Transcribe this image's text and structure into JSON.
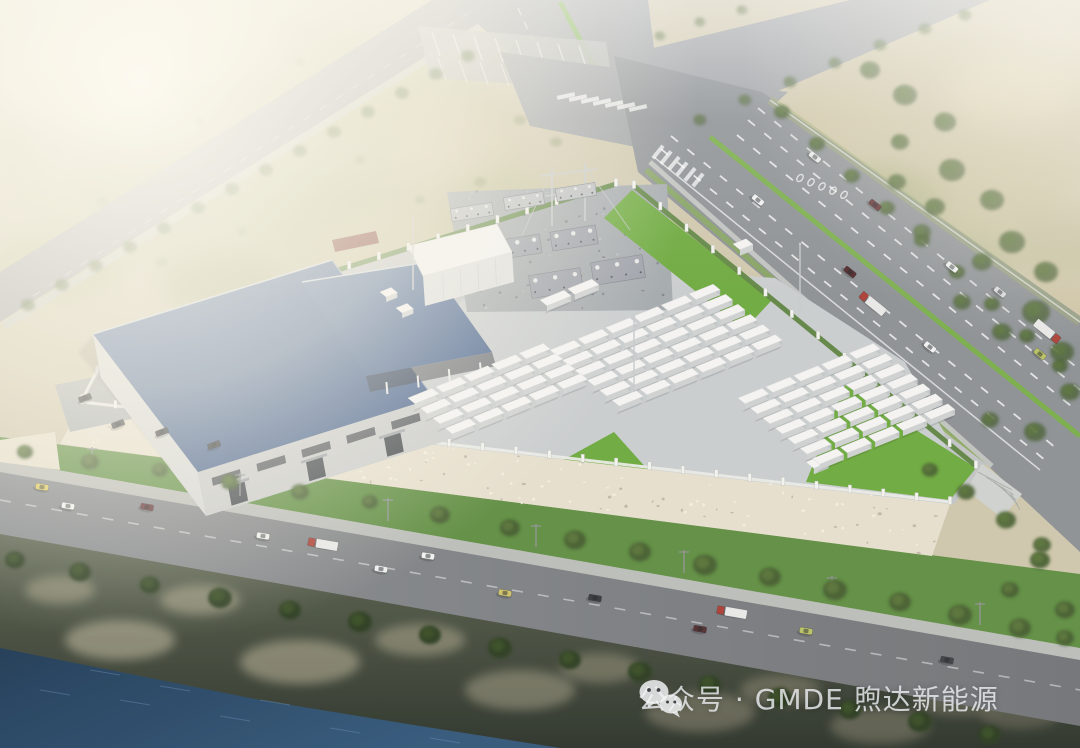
{
  "watermark": {
    "icon": "wechat-icon",
    "text": "公众号 · GMDE 煦达新能源"
  },
  "scene": {
    "subject": "aerial rendering of battery energy storage power station",
    "palette": {
      "land": "#ccc5a9",
      "road": "#989da0",
      "highway": "#878c90",
      "road_bottom_l": "#84888b",
      "road_bottom_r": "#6b6e71",
      "sidewalk": "#b8bbb7",
      "median": "#72ad3f",
      "lawn": "#67a636",
      "hedge": "#567f37",
      "verge": "#7fa451",
      "facility": "#bdc1c3",
      "yard": "#c7cbcd",
      "gravel": "#a0a6aa",
      "slope": "#e4decb",
      "wall": "#e9ebe6",
      "post": "#f1f2ee",
      "roof_hi": "#54719e",
      "roof_lo": "#3e5a86",
      "canopy_hi": "#53709b",
      "canopy_lo": "#45618c",
      "facade": "#c7c9c8",
      "facade_side": "#d4d6d4",
      "window": "#50555b",
      "door": "#3a3f45",
      "container_top": "#f3f4f2",
      "container_front": "#ccd0d0",
      "container_cap": "#bfc4c4",
      "white_bldg": "#f0f1ef",
      "white_bldg_front": "#dcdedd",
      "trailer": "#7c3a2c",
      "water_deep": "#16334f",
      "water": "#2a5175",
      "bank_hi": "#57604a",
      "bank_lo": "#232b21",
      "tree": "#3c5628",
      "tree_hi": "#557233",
      "tree_dark": "#243618",
      "tree_dark_hi": "#31491f",
      "truck_red": "#a8382e",
      "trailer_box": "#e7e8e6",
      "mast": "#c3c7c9",
      "pole": "#8e9092"
    },
    "vehicles": {
      "bottom_road_angle": 10,
      "highway_angle": 39,
      "parked_angle": -21,
      "bottom_road": [
        {
          "x": 42,
          "y": 487,
          "c": "#d9c85c",
          "t": "car"
        },
        {
          "x": 68,
          "y": 506,
          "c": "#f0f1ef",
          "t": "car"
        },
        {
          "x": 147,
          "y": 507,
          "c": "#5e2b2e",
          "t": "car"
        },
        {
          "x": 263,
          "y": 536,
          "c": "#edefee",
          "t": "car"
        },
        {
          "x": 322,
          "y": 544,
          "c": "#a8382e",
          "t": "truck",
          "f": -1
        },
        {
          "x": 381,
          "y": 569,
          "c": "#edefee",
          "t": "car"
        },
        {
          "x": 428,
          "y": 556,
          "c": "#f0f1ef",
          "t": "car"
        },
        {
          "x": 505,
          "y": 593,
          "c": "#cdbf63",
          "t": "car"
        },
        {
          "x": 595,
          "y": 598,
          "c": "#2e3236",
          "t": "car"
        },
        {
          "x": 731,
          "y": 612,
          "c": "#a8382e",
          "t": "truck",
          "f": -1
        },
        {
          "x": 700,
          "y": 629,
          "c": "#4a2527",
          "t": "car"
        },
        {
          "x": 806,
          "y": 631,
          "c": "#b6c05f",
          "t": "car"
        },
        {
          "x": 947,
          "y": 660,
          "c": "#34393c",
          "t": "car"
        }
      ],
      "highway": [
        {
          "x": 758,
          "y": 200,
          "c": "#eef0ef",
          "t": "car"
        },
        {
          "x": 815,
          "y": 157,
          "c": "#e8eae9",
          "t": "car"
        },
        {
          "x": 875,
          "y": 205,
          "c": "#5a2528",
          "t": "car"
        },
        {
          "x": 850,
          "y": 272,
          "c": "#4a2023",
          "t": "car"
        },
        {
          "x": 872,
          "y": 303,
          "c": "#a8382e",
          "t": "truck",
          "f": -1
        },
        {
          "x": 952,
          "y": 267,
          "c": "#eef0ef",
          "t": "car"
        },
        {
          "x": 1000,
          "y": 292,
          "c": "#d6d8d9",
          "t": "car"
        },
        {
          "x": 930,
          "y": 347,
          "c": "#eef0ef",
          "t": "car"
        },
        {
          "x": 1048,
          "y": 332,
          "c": "#a8382e",
          "t": "truck",
          "f": 1
        },
        {
          "x": 1040,
          "y": 354,
          "c": "#b5bf5c",
          "t": "car"
        }
      ],
      "parked": [
        {
          "x": 162,
          "y": 432,
          "c": "#33383c"
        },
        {
          "x": 214,
          "y": 445,
          "c": "#2c3034"
        },
        {
          "x": 118,
          "y": 424,
          "c": "#3d4145"
        },
        {
          "x": 85,
          "y": 398,
          "c": "#2f3337"
        }
      ]
    },
    "trees": {
      "nw_roadside": [
        [
          28,
          305
        ],
        [
          62,
          285
        ],
        [
          96,
          266
        ],
        [
          130,
          247
        ],
        [
          164,
          228
        ],
        [
          198,
          208
        ],
        [
          232,
          189
        ],
        [
          266,
          170
        ],
        [
          300,
          151
        ],
        [
          334,
          132
        ],
        [
          368,
          112
        ],
        [
          402,
          93
        ],
        [
          436,
          74
        ],
        [
          468,
          56
        ]
      ],
      "road_c_south": [
        [
          700,
          120
        ],
        [
          745,
          100
        ],
        [
          790,
          82
        ],
        [
          835,
          63
        ],
        [
          880,
          45
        ],
        [
          925,
          29
        ],
        [
          965,
          15
        ]
      ],
      "road_c_north": [
        [
          660,
          36
        ],
        [
          700,
          22
        ],
        [
          742,
          10
        ]
      ],
      "highway_edge": [
        [
          782,
          112
        ],
        [
          817,
          144
        ],
        [
          852,
          176
        ],
        [
          887,
          208
        ],
        [
          922,
          240
        ],
        [
          957,
          272
        ],
        [
          992,
          304
        ],
        [
          1027,
          336
        ],
        [
          1060,
          366
        ]
      ],
      "scrub_right": [
        [
          870,
          70,
          10
        ],
        [
          905,
          95,
          12
        ],
        [
          945,
          122,
          11
        ],
        [
          900,
          142,
          9
        ],
        [
          952,
          170,
          13
        ],
        [
          992,
          200,
          12
        ],
        [
          935,
          207,
          10
        ],
        [
          1012,
          242,
          13
        ],
        [
          1046,
          272,
          12
        ],
        [
          982,
          262,
          10
        ],
        [
          1036,
          312,
          14
        ],
        [
          1002,
          332,
          10
        ],
        [
          1062,
          352,
          12
        ],
        [
          922,
          232,
          9
        ],
        [
          962,
          302,
          9
        ],
        [
          897,
          182,
          9
        ],
        [
          1070,
          392,
          10
        ],
        [
          1035,
          432,
          11
        ],
        [
          990,
          420,
          9
        ]
      ],
      "scrub_left": [
        [
          520,
          120,
          6
        ],
        [
          556,
          142,
          6
        ],
        [
          480,
          182,
          6
        ],
        [
          300,
          62,
          5
        ],
        [
          200,
          122,
          5
        ],
        [
          102,
          202,
          6
        ],
        [
          162,
          262,
          6
        ],
        [
          242,
          232,
          5
        ],
        [
          420,
          200,
          5
        ],
        [
          360,
          160,
          5
        ]
      ],
      "south_band": [
        [
          25,
          452,
          8
        ],
        [
          90,
          462,
          9
        ],
        [
          160,
          470,
          8
        ],
        [
          230,
          482,
          9
        ],
        [
          300,
          492,
          9
        ],
        [
          370,
          502,
          8
        ],
        [
          440,
          515,
          10
        ],
        [
          510,
          528,
          10
        ],
        [
          575,
          540,
          11
        ],
        [
          640,
          552,
          11
        ],
        [
          705,
          565,
          12
        ],
        [
          770,
          577,
          11
        ],
        [
          835,
          590,
          12
        ],
        [
          900,
          602,
          11
        ],
        [
          960,
          615,
          12
        ],
        [
          1020,
          628,
          11
        ],
        [
          1065,
          638,
          9
        ],
        [
          1040,
          560,
          10
        ],
        [
          1010,
          590,
          9
        ],
        [
          1065,
          610,
          10
        ]
      ],
      "river_band": [
        [
          15,
          560,
          10
        ],
        [
          80,
          572,
          11
        ],
        [
          150,
          585,
          10
        ],
        [
          220,
          598,
          12
        ],
        [
          290,
          610,
          11
        ],
        [
          360,
          622,
          12
        ],
        [
          430,
          635,
          11
        ],
        [
          500,
          648,
          12
        ],
        [
          570,
          660,
          11
        ],
        [
          640,
          672,
          12
        ],
        [
          710,
          685,
          11
        ],
        [
          780,
          698,
          12
        ],
        [
          850,
          710,
          11
        ],
        [
          920,
          722,
          12
        ],
        [
          990,
          735,
          11
        ]
      ],
      "lawn_se": [
        [
          930,
          470,
          8
        ],
        [
          966,
          492,
          9
        ],
        [
          1006,
          520,
          10
        ],
        [
          1042,
          545,
          9
        ]
      ]
    },
    "container_clusters": [
      {
        "ox": 540,
        "oy": 300,
        "cols": 2,
        "rows": 1
      },
      {
        "ox": 550,
        "oy": 350,
        "cols": 6,
        "rows": 6
      },
      {
        "ox": 738,
        "oy": 398,
        "cols": 5,
        "rows": 7
      },
      {
        "ox": 408,
        "oy": 398,
        "cols": 5,
        "rows": 4
      }
    ],
    "fences": [
      {
        "a": [
          112,
          340
        ],
        "b": [
          616,
          184
        ],
        "n": 17,
        "hedge": true
      },
      {
        "a": [
          634,
          186
        ],
        "b": [
          976,
          466
        ],
        "n": 13,
        "hedge": true
      },
      {
        "a": [
          82,
          402
        ],
        "b": [
          950,
          502
        ],
        "n": 26,
        "hedge": false
      },
      {
        "a": [
          82,
          400
        ],
        "b": [
          112,
          342
        ],
        "n": 2,
        "hedge": false
      }
    ],
    "substation_equipment": [
      {
        "x": 472,
        "y": 212,
        "w": 42,
        "h": 13
      },
      {
        "x": 524,
        "y": 201,
        "w": 40,
        "h": 13
      },
      {
        "x": 576,
        "y": 192,
        "w": 40,
        "h": 13
      },
      {
        "x": 518,
        "y": 247,
        "w": 46,
        "h": 19
      },
      {
        "x": 574,
        "y": 238,
        "w": 46,
        "h": 19
      },
      {
        "x": 556,
        "y": 283,
        "w": 52,
        "h": 23
      },
      {
        "x": 618,
        "y": 270,
        "w": 52,
        "h": 23
      },
      {
        "x": 478,
        "y": 252,
        "w": 18,
        "h": 11
      },
      {
        "x": 470,
        "y": 287,
        "w": 20,
        "h": 12
      }
    ],
    "masts": [
      [
        413,
        290,
        72
      ],
      [
        634,
        392,
        76
      ],
      [
        800,
        312,
        68
      ]
    ],
    "utility_poles": [
      [
        92,
        470
      ],
      [
        240,
        496
      ],
      [
        388,
        521
      ],
      [
        536,
        547
      ],
      [
        684,
        573
      ],
      [
        832,
        599
      ],
      [
        980,
        625
      ]
    ],
    "scrub_patches_left": [
      [
        260,
        150,
        260,
        130,
        "#b7b88e",
        0.55
      ],
      [
        80,
        80,
        90,
        50,
        "#e2d8ba",
        0.7
      ],
      [
        205,
        42,
        80,
        40,
        "#d9cfae",
        0.7
      ],
      [
        350,
        95,
        85,
        45,
        "#c2bd92",
        0.7
      ],
      [
        150,
        185,
        75,
        40,
        "#a9ad7c",
        0.7
      ],
      [
        305,
        205,
        80,
        42,
        "#b4b78a",
        0.7
      ],
      [
        455,
        142,
        70,
        38,
        "#cfc8a4",
        0.7
      ],
      [
        62,
        262,
        62,
        34,
        "#b0b282",
        0.7
      ],
      [
        385,
        252,
        68,
        36,
        "#c9c19c",
        0.7
      ],
      [
        505,
        202,
        60,
        32,
        "#bdbb90",
        0.6
      ],
      [
        222,
        282,
        60,
        32,
        "#a5a97a",
        0.7
      ]
    ],
    "scrub_patches_right": [
      [
        940,
        140,
        150,
        110,
        "#c6c09c",
        0.6
      ],
      [
        1000,
        183,
        70,
        40,
        "#c4bd98",
        0.75
      ],
      [
        950,
        262,
        65,
        38,
        "#b6b78c",
        0.7
      ],
      [
        1042,
        322,
        70,
        40,
        "#c9c09c",
        0.7
      ],
      [
        882,
        202,
        60,
        36,
        "#abb07e",
        0.7
      ],
      [
        1012,
        92,
        65,
        36,
        "#d6cdaa",
        0.75
      ],
      [
        1062,
        242,
        55,
        32,
        "#bdb993",
        0.7
      ],
      [
        922,
        332,
        60,
        34,
        "#b2b386",
        0.7
      ],
      [
        1052,
        422,
        60,
        36,
        "#b7b58b",
        0.7
      ],
      [
        840,
        120,
        55,
        30,
        "#cdc5a2",
        0.6
      ]
    ],
    "rock_patches": [
      [
        120,
        640,
        55,
        20,
        "#cdc4a8",
        0.5
      ],
      [
        300,
        662,
        60,
        22,
        "#c2b99d",
        0.5
      ],
      [
        520,
        690,
        55,
        20,
        "#b5ad92",
        0.45
      ],
      [
        700,
        712,
        55,
        20,
        "#a99f86",
        0.4
      ],
      [
        880,
        726,
        50,
        18,
        "#9b947c",
        0.4
      ],
      [
        200,
        600,
        40,
        15,
        "#c8bfa2",
        0.45
      ],
      [
        420,
        640,
        45,
        16,
        "#bdb498",
        0.45
      ],
      [
        960,
        700,
        45,
        16,
        "#958e77",
        0.4
      ],
      [
        60,
        590,
        35,
        14,
        "#c8bfa2",
        0.4
      ],
      [
        600,
        668,
        40,
        15,
        "#b0a78c",
        0.4
      ],
      [
        780,
        690,
        40,
        15,
        "#a49a80",
        0.4
      ],
      [
        1020,
        715,
        40,
        14,
        "#8f8872",
        0.35
      ]
    ]
  }
}
